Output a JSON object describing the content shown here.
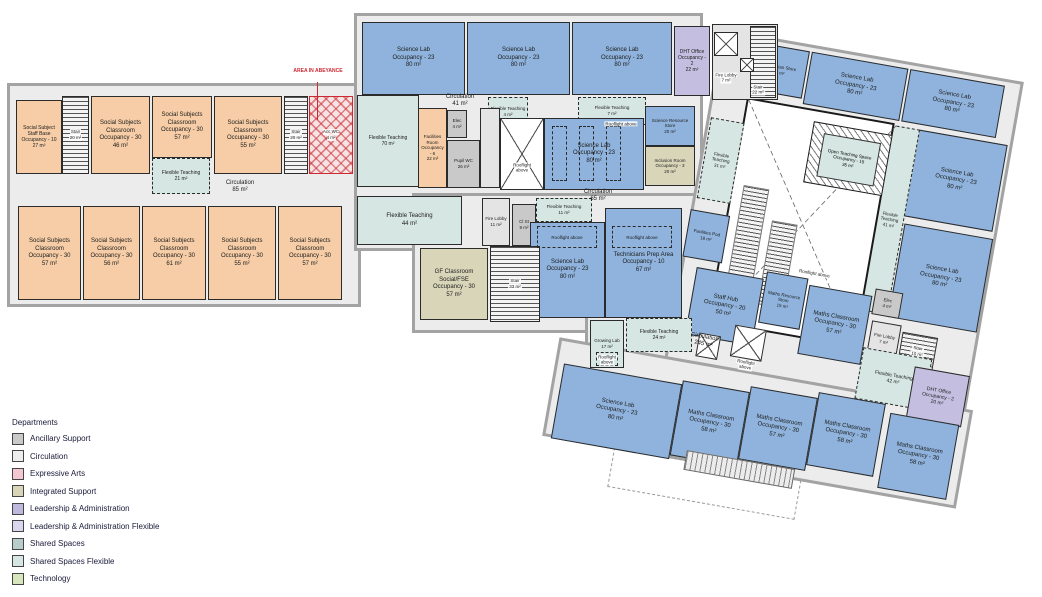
{
  "annotation": {
    "abeyance": "AREA IN ABEYANCE"
  },
  "legend": {
    "title": "Departments",
    "items": [
      {
        "label": "Ancillary Support",
        "color": "#c9c9c9"
      },
      {
        "label": "Circulation",
        "color": "#ededed"
      },
      {
        "label": "Expressive Arts",
        "color": "#f2c7d2"
      },
      {
        "label": "Integrated Support",
        "color": "#d9d5b9"
      },
      {
        "label": "Leadership & Administration",
        "color": "#beb9dc"
      },
      {
        "label": "Leadership & Administration Flexible",
        "color": "#d9d6ee"
      },
      {
        "label": "Shared Spaces",
        "color": "#b7cdcb"
      },
      {
        "label": "Shared Spaces Flexible",
        "color": "#d6e6e3"
      },
      {
        "label": "Technology",
        "color": "#d7e6bc"
      }
    ]
  },
  "colors": {
    "blue": "#8fb3dc",
    "orange": "#f6cda6",
    "tealflex": "#d6e6e3",
    "beige": "#d9d5b9",
    "purple": "#c4bfe0",
    "gray": "#c9c9c9",
    "lgray": "#e4e4e4",
    "circ": "#ececec",
    "wall": "#a3a3a3",
    "line": "#2b2b2b",
    "red": "#cc2a33"
  },
  "rooms": {
    "ssStaff": {
      "l1": "Social Subject Staff Base",
      "l2": "Occupancy - 10",
      "l3": "27 m²"
    },
    "stairL1": {
      "l1": "Stair",
      "l2": "20 m²"
    },
    "ssc46": {
      "l1": "Social Subjects Classroom",
      "l2": "Occupancy - 30",
      "l3": "46 m²"
    },
    "ssc57a": {
      "l1": "Social Subjects Classroom",
      "l2": "Occupancy - 30",
      "l3": "57 m²"
    },
    "ft21": {
      "l1": "Flexible Teaching",
      "l2": "21 m²"
    },
    "ssc55a": {
      "l1": "Social Subjects Classroom",
      "l2": "Occupancy - 30",
      "l3": "55 m²"
    },
    "stairL2": {
      "l1": "Stair",
      "l2": "20 m²"
    },
    "accwc": {
      "l1": "Acc WC",
      "l2": "4 m²"
    },
    "circ85": {
      "l1": "Circulation",
      "l2": "85 m²"
    },
    "ssc57b": {
      "l1": "Social Subjects Classroom",
      "l2": "Occupancy - 30",
      "l3": "57 m²"
    },
    "ssc56": {
      "l1": "Social Subjects Classroom",
      "l2": "Occupancy - 30",
      "l3": "56 m²"
    },
    "ssc61": {
      "l1": "Social Subjects Classroom",
      "l2": "Occupancy - 30",
      "l3": "61 m²"
    },
    "ssc55b": {
      "l1": "Social Subjects Classroom",
      "l2": "Occupancy - 30",
      "l3": "55 m²"
    },
    "ssc57c": {
      "l1": "Social Subjects Classroom",
      "l2": "Occupancy - 30",
      "l3": "57 m²"
    },
    "lab1": {
      "l1": "Science Lab",
      "l2": "Occupancy - 23",
      "l3": "80 m²"
    },
    "lab2": {
      "l1": "Science Lab",
      "l2": "Occupancy - 23",
      "l3": "80 m²"
    },
    "lab3": {
      "l1": "Science Lab",
      "l2": "Occupancy - 23",
      "l3": "80 m²"
    },
    "dht22": {
      "l1": "DHT Office",
      "l2": "Occupancy - 2",
      "l3": "22 m²"
    },
    "fireLobby7a": {
      "l1": "Fire Lobby",
      "l2": "7 m²"
    },
    "stair22": {
      "l1": "Stair",
      "l2": "22 m²"
    },
    "circ41": {
      "l1": "Circulation",
      "l2": "41 m²"
    },
    "ft4": {
      "l1": "Flexible Teaching",
      "l2": "4 m²"
    },
    "ft7": {
      "l1": "Flexible Teaching",
      "l2": "7 m²"
    },
    "ft70": {
      "l1": "Flexible Teaching",
      "l2": "70 m²"
    },
    "facRoom": {
      "l1": "Facilities Room",
      "l2": "Occupancy - 6",
      "l3": "22 m²"
    },
    "elec4a": {
      "l1": "Elec",
      "l2": "4 m²"
    },
    "pupilWC": {
      "l1": "Pupil WC",
      "l2": "26 m²"
    },
    "roofl1": {
      "l1": "Rooflight",
      "l2": "above"
    },
    "lab4": {
      "l1": "Science Lab",
      "l2": "Occupancy - 23",
      "l3": "80 m²"
    },
    "roofLab4": {
      "l1": "Rooflight above"
    },
    "sciStore": {
      "l1": "Science Resource Store",
      "l2": "20 m²"
    },
    "inclusion": {
      "l1": "Inclusion Room",
      "l2": "Occupancy - 3",
      "l3": "20 m²"
    },
    "circ65": {
      "l1": "Circulation",
      "l2": "65 m²"
    },
    "ft44": {
      "l1": "Flexible Teaching",
      "l2": "44 m²"
    },
    "fireLobby11": {
      "l1": "Fire Lobby",
      "l2": "11 m²"
    },
    "clst9": {
      "l1": "Cl St",
      "l2": "9 m²"
    },
    "ft11": {
      "l1": "Flexible Teaching",
      "l2": "11 m²"
    },
    "lab5": {
      "l1": "Science Lab",
      "l2": "Occupancy - 23",
      "l3": "80 m²"
    },
    "roofLab5": {
      "l1": "Rooflight above"
    },
    "techPrep": {
      "l1": "Technicians Prep Area",
      "l2": "Occupancy - 10",
      "l3": "67 m²"
    },
    "roofTech": {
      "l1": "Rooflight above"
    },
    "gfClassroom": {
      "l1": "GF Classroom Social/FSE",
      "l2": "Occupancy - 30",
      "l3": "57 m²"
    },
    "stair33": {
      "l1": "Stair",
      "l2": "33 m²"
    },
    "growing": {
      "l1": "Growing Lab",
      "l2": "17 m²"
    },
    "roofGrow": {
      "l1": "Rooflight",
      "l2": "above"
    },
    "ft24": {
      "l1": "Flexible Teaching",
      "l2": "24 m²"
    },
    "techStore": {
      "l1": "Technician Store",
      "l2": "10 m²"
    },
    "labA": {
      "l1": "Science Lab",
      "l2": "Occupancy - 23",
      "l3": "80 m²"
    },
    "labB": {
      "l1": "Science Lab",
      "l2": "Occupancy - 23",
      "l3": "80 m²"
    },
    "labC": {
      "l1": "Science Lab",
      "l2": "Occupancy - 23",
      "l3": "80 m²"
    },
    "labD": {
      "l1": "Science Lab",
      "l2": "Occupancy - 23",
      "l3": "80 m²"
    },
    "labE": {
      "l1": "Science Lab",
      "l2": "Occupancy - 23",
      "l3": "80 m²"
    },
    "ft41": {
      "l1": "Flexible Teaching",
      "l2": "41 m²"
    },
    "ft31": {
      "l1": "Flexible Teaching",
      "l2": "31 m²"
    },
    "facPod": {
      "l1": "Facilities Pod",
      "l2": "18 m²"
    },
    "openTeach": {
      "l1": "Open Teaching Space",
      "l2": "Occupancy - 15",
      "l3": "35 m²"
    },
    "courtyardRoof": {
      "l1": "Rooflight above"
    },
    "circ245": {
      "l1": "Circulation",
      "l2": "245 m²"
    },
    "roofCorr": {
      "l1": "Rooflight",
      "l2": "above"
    },
    "staffHub": {
      "l1": "Staff Hub",
      "l2": "Occupancy - 20",
      "l3": "50 m²"
    },
    "mathsStore": {
      "l1": "Maths Resource Store",
      "l2": "15 m²"
    },
    "mathsA": {
      "l1": "Maths Classroom",
      "l2": "Occupancy - 30",
      "l3": "57 m²"
    },
    "mathsB": {
      "l1": "Maths Classroom",
      "l2": "Occupancy - 30",
      "l3": "58 m²"
    },
    "mathsC": {
      "l1": "Maths Classroom",
      "l2": "Occupancy - 30",
      "l3": "57 m²"
    },
    "mathsD": {
      "l1": "Maths Classroom",
      "l2": "Occupancy - 30",
      "l3": "58 m²"
    },
    "mathsE": {
      "l1": "Maths Classroom",
      "l2": "Occupancy - 30",
      "l3": "58 m²"
    },
    "dht20": {
      "l1": "DHT Office",
      "l2": "Occupancy - 2",
      "l3": "20 m²"
    },
    "ft42": {
      "l1": "Flexible Teaching",
      "l2": "42 m²"
    },
    "fireLobby7b": {
      "l1": "Fire Lobby",
      "l2": "7 m²"
    },
    "stair10": {
      "l1": "Stair",
      "l2": "10 m²"
    },
    "elec4b": {
      "l1": "Elec",
      "l2": "4 m²"
    }
  }
}
